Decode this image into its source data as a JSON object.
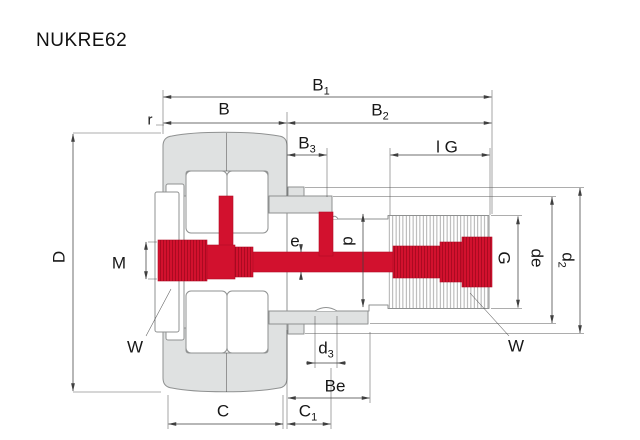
{
  "title": "NUKRE62",
  "colors": {
    "red": "#d2112e",
    "gray": "#dfe1e1",
    "outline": "#8f9191",
    "dim": "#3f3f3f"
  },
  "labels": {
    "B1": {
      "main": "B",
      "sub": "1"
    },
    "B": {
      "main": "B",
      "sub": ""
    },
    "B2": {
      "main": "B",
      "sub": "2"
    },
    "B3": {
      "main": "B",
      "sub": "3"
    },
    "r": {
      "main": "r",
      "sub": ""
    },
    "IG": {
      "main": "l G",
      "sub": ""
    },
    "D": {
      "main": "D",
      "sub": ""
    },
    "M": {
      "main": "M",
      "sub": ""
    },
    "e": {
      "main": "e",
      "sub": ""
    },
    "d": {
      "main": "d",
      "sub": ""
    },
    "G": {
      "main": "G",
      "sub": ""
    },
    "de": {
      "main": "de",
      "sub": ""
    },
    "d2": {
      "main": "d",
      "sub": "2"
    },
    "W_left": {
      "main": "W",
      "sub": ""
    },
    "W_right": {
      "main": "W",
      "sub": ""
    },
    "d3": {
      "main": "d",
      "sub": "3"
    },
    "Be": {
      "main": "Be",
      "sub": ""
    },
    "C": {
      "main": "C",
      "sub": ""
    },
    "C1": {
      "main": "C",
      "sub": "1"
    }
  }
}
